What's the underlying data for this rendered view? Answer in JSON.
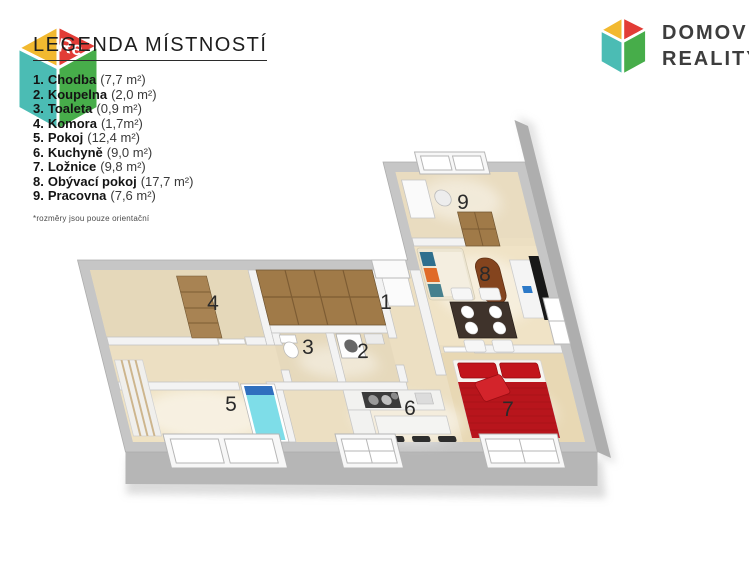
{
  "legend": {
    "title": "LEGENDA MÍSTNOSTÍ",
    "items": [
      {
        "num": "1.",
        "name": "Chodba",
        "area": "(7,7 m²)"
      },
      {
        "num": "2.",
        "name": "Koupelna",
        "area": "(2,0 m²)"
      },
      {
        "num": "3.",
        "name": "Toaleta",
        "area": "(0,9 m²)"
      },
      {
        "num": "4.",
        "name": "Komora",
        "area": "(1,7m²)"
      },
      {
        "num": "5.",
        "name": "Pokoj",
        "area": "(12,4 m²)"
      },
      {
        "num": "6.",
        "name": "Kuchyně",
        "area": "(9,0 m²)"
      },
      {
        "num": "7.",
        "name": "Ložnice",
        "area": "(9,8 m²)"
      },
      {
        "num": "8.",
        "name": "Obývací pokoj",
        "area": "(17,7 m²)"
      },
      {
        "num": "9.",
        "name": "Pracovna",
        "area": "(7,6 m²)"
      }
    ],
    "footnote": "*rozměry jsou pouze orientační"
  },
  "brand": {
    "line1": "DOMOV",
    "line2": "REALITY"
  },
  "watermark": {
    "text": "Re"
  },
  "plan": {
    "room_labels": [
      {
        "n": "1"
      },
      {
        "n": "2"
      },
      {
        "n": "3"
      },
      {
        "n": "4"
      },
      {
        "n": "5"
      },
      {
        "n": "6"
      },
      {
        "n": "7"
      },
      {
        "n": "8"
      },
      {
        "n": "9"
      }
    ]
  },
  "colors": {
    "brand_yellow": "#f2b930",
    "brand_red": "#e23c36",
    "brand_teal": "#4bbcb4",
    "brand_green": "#47ad4a",
    "wall_top": "#c6c6c6",
    "wall_face_south": "#b6b6b6",
    "wall_face_east": "#aeaeae",
    "floor_wood": "#ecdfc2",
    "furniture_wood": "#a07a48",
    "bed_red": "#b8151c",
    "accent_aqua": "#7edde8"
  }
}
